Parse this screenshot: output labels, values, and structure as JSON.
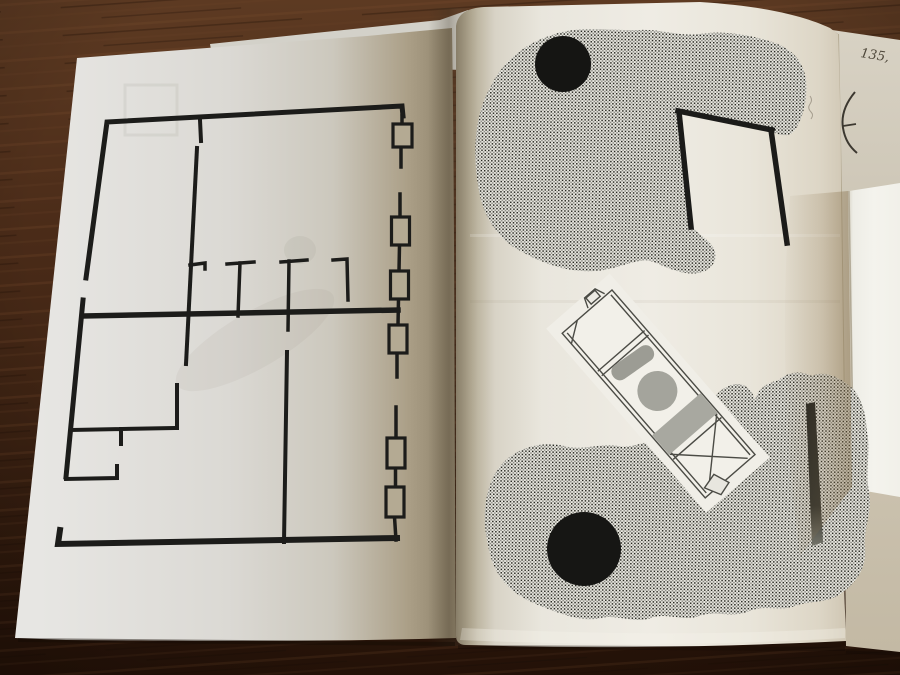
{
  "scene": {
    "type": "photograph of an open art booklet lying on a dark wooden table"
  },
  "annotations": {
    "handwritten_page_number": "135,"
  },
  "left_page": {
    "content": "black-line architectural floor plan",
    "window_symbols": 6
  },
  "right_page": {
    "content": "halftone-dot blob collage",
    "black_dots": 2,
    "elements": [
      "top halftone blob",
      "bottom halftone blob",
      "door-frame corner lines",
      "tilted technical device illustration",
      "dark diagonal bar"
    ]
  },
  "side_papers": {
    "items": [
      "underlying sheet with arc sketch",
      "bright white card"
    ]
  },
  "colors": {
    "wood_dark": "#2b1509",
    "wood_light": "#5d3a22",
    "page_left": "#d9d7d1",
    "page_right": "#efece4",
    "page_shadow_tan": "#a5987e",
    "under_page": "#cfc8b9",
    "card_white": "#f3f2ec",
    "ink": "#1b1b19",
    "halftone_gray": "#93938c",
    "device_gray": "#a4a49c"
  }
}
